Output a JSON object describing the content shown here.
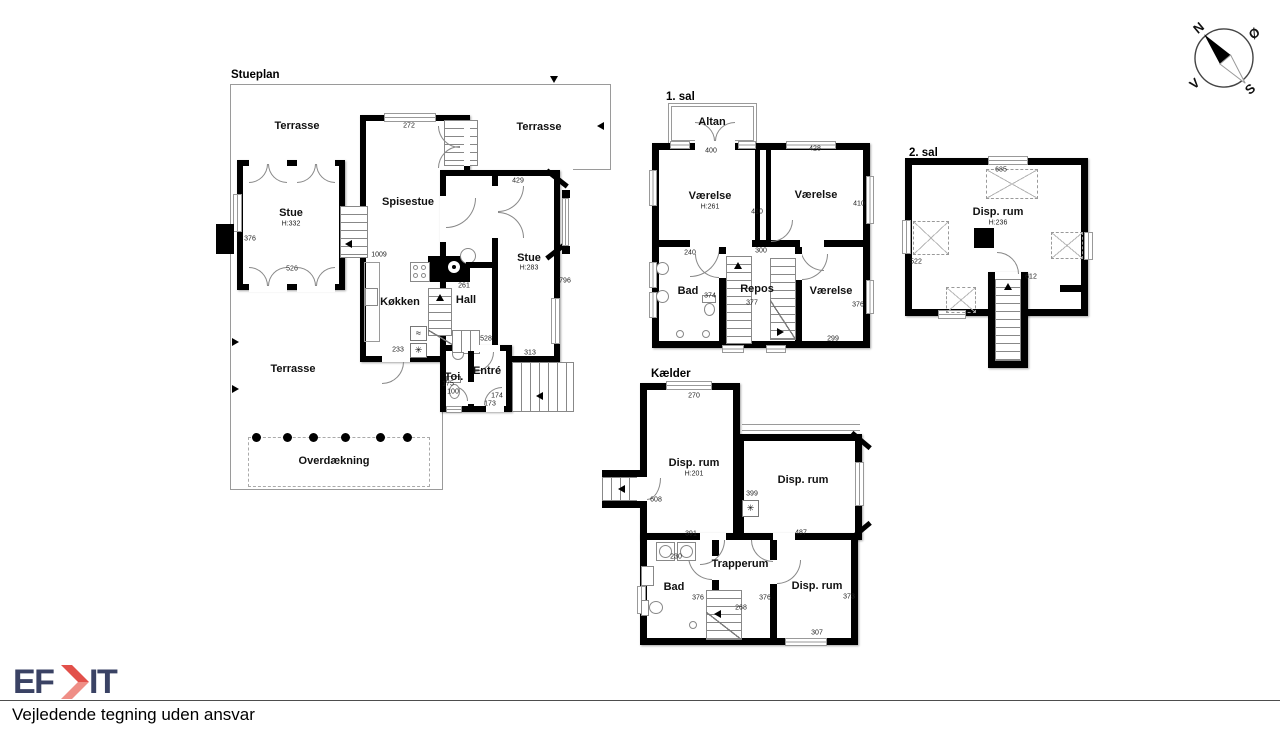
{
  "footer": {
    "logo_text_left": "EF",
    "logo_text_right": "IT",
    "logo_color": "#3a4264",
    "logo_accent": "#e2504a",
    "logo_accent_light": "#ef8e86",
    "disclaimer": "Vejledende tegning uden ansvar"
  },
  "compass": {
    "north": "N",
    "east": "Ø",
    "south": "S",
    "west": "V"
  },
  "icons": {
    "freezer": "✳",
    "cooler": "≈"
  },
  "plans": [
    {
      "id": "stueplan",
      "title": "Stueplan",
      "room_labels": [
        {
          "text": "Terrasse",
          "x": 297,
          "y": 126
        },
        {
          "text": "Terrasse",
          "x": 539,
          "y": 127
        },
        {
          "text": "Stue",
          "x": 291,
          "y": 213
        },
        {
          "text": "H:332",
          "x": 291,
          "y": 224,
          "small": true
        },
        {
          "text": "Spisestue",
          "x": 408,
          "y": 202
        },
        {
          "text": "Stue",
          "x": 529,
          "y": 258
        },
        {
          "text": "H:283",
          "x": 529,
          "y": 268,
          "small": true
        },
        {
          "text": "Køkken",
          "x": 400,
          "y": 302
        },
        {
          "text": "Hall",
          "x": 466,
          "y": 300
        },
        {
          "text": "Toi.",
          "x": 454,
          "y": 377
        },
        {
          "text": "Entré",
          "x": 487,
          "y": 371
        },
        {
          "text": "Terrasse",
          "x": 293,
          "y": 369
        },
        {
          "text": "Overdækning",
          "x": 334,
          "y": 461
        }
      ],
      "dim_labels": [
        {
          "text": "272",
          "x": 409,
          "y": 126
        },
        {
          "text": "429",
          "x": 518,
          "y": 181
        },
        {
          "text": "376",
          "x": 250,
          "y": 239
        },
        {
          "text": "526",
          "x": 292,
          "y": 269
        },
        {
          "text": "1009",
          "x": 379,
          "y": 255
        },
        {
          "text": "261",
          "x": 464,
          "y": 286
        },
        {
          "text": "796",
          "x": 565,
          "y": 281
        },
        {
          "text": "233",
          "x": 398,
          "y": 350
        },
        {
          "text": "528",
          "x": 486,
          "y": 339
        },
        {
          "text": "313",
          "x": 530,
          "y": 353
        },
        {
          "text": "175",
          "x": 448,
          "y": 384
        },
        {
          "text": "100",
          "x": 453,
          "y": 392
        },
        {
          "text": "174",
          "x": 497,
          "y": 396
        },
        {
          "text": "173",
          "x": 490,
          "y": 404
        }
      ]
    },
    {
      "id": "sal1",
      "title": "1. sal",
      "room_labels": [
        {
          "text": "Altan",
          "x": 712,
          "y": 122
        },
        {
          "text": "Værelse",
          "x": 710,
          "y": 196
        },
        {
          "text": "H:261",
          "x": 710,
          "y": 207,
          "small": true
        },
        {
          "text": "Værelse",
          "x": 816,
          "y": 195
        },
        {
          "text": "Bad",
          "x": 688,
          "y": 291
        },
        {
          "text": "Repos",
          "x": 757,
          "y": 289
        },
        {
          "text": "Værelse",
          "x": 831,
          "y": 291
        }
      ],
      "dim_labels": [
        {
          "text": "400",
          "x": 711,
          "y": 151
        },
        {
          "text": "428",
          "x": 815,
          "y": 149
        },
        {
          "text": "410",
          "x": 757,
          "y": 212
        },
        {
          "text": "410",
          "x": 859,
          "y": 204
        },
        {
          "text": "240",
          "x": 690,
          "y": 253
        },
        {
          "text": "300",
          "x": 761,
          "y": 251
        },
        {
          "text": "374",
          "x": 710,
          "y": 296
        },
        {
          "text": "377",
          "x": 752,
          "y": 303
        },
        {
          "text": "376",
          "x": 858,
          "y": 305
        },
        {
          "text": "299",
          "x": 833,
          "y": 339
        }
      ]
    },
    {
      "id": "sal2",
      "title": "2. sal",
      "room_labels": [
        {
          "text": "Disp. rum",
          "x": 998,
          "y": 212
        },
        {
          "text": "H:236",
          "x": 998,
          "y": 223,
          "small": true
        }
      ],
      "dim_labels": [
        {
          "text": "685",
          "x": 1001,
          "y": 170
        },
        {
          "text": "522",
          "x": 916,
          "y": 262
        },
        {
          "text": "612",
          "x": 1031,
          "y": 277
        }
      ]
    },
    {
      "id": "kaelder",
      "title": "Kælder",
      "room_labels": [
        {
          "text": "Disp. rum",
          "x": 694,
          "y": 463
        },
        {
          "text": "H:201",
          "x": 694,
          "y": 474,
          "small": true
        },
        {
          "text": "Disp. rum",
          "x": 803,
          "y": 480
        },
        {
          "text": "Bad",
          "x": 674,
          "y": 587
        },
        {
          "text": "Trapperum",
          "x": 740,
          "y": 564
        },
        {
          "text": "Disp. rum",
          "x": 817,
          "y": 586
        }
      ],
      "dim_labels": [
        {
          "text": "270",
          "x": 694,
          "y": 396
        },
        {
          "text": "608",
          "x": 656,
          "y": 500
        },
        {
          "text": "399",
          "x": 752,
          "y": 494
        },
        {
          "text": "391",
          "x": 691,
          "y": 534
        },
        {
          "text": "487",
          "x": 801,
          "y": 533
        },
        {
          "text": "230",
          "x": 676,
          "y": 557
        },
        {
          "text": "376",
          "x": 698,
          "y": 598
        },
        {
          "text": "376",
          "x": 765,
          "y": 598
        },
        {
          "text": "268",
          "x": 741,
          "y": 608
        },
        {
          "text": "373",
          "x": 849,
          "y": 597
        },
        {
          "text": "307",
          "x": 817,
          "y": 633
        }
      ]
    }
  ]
}
